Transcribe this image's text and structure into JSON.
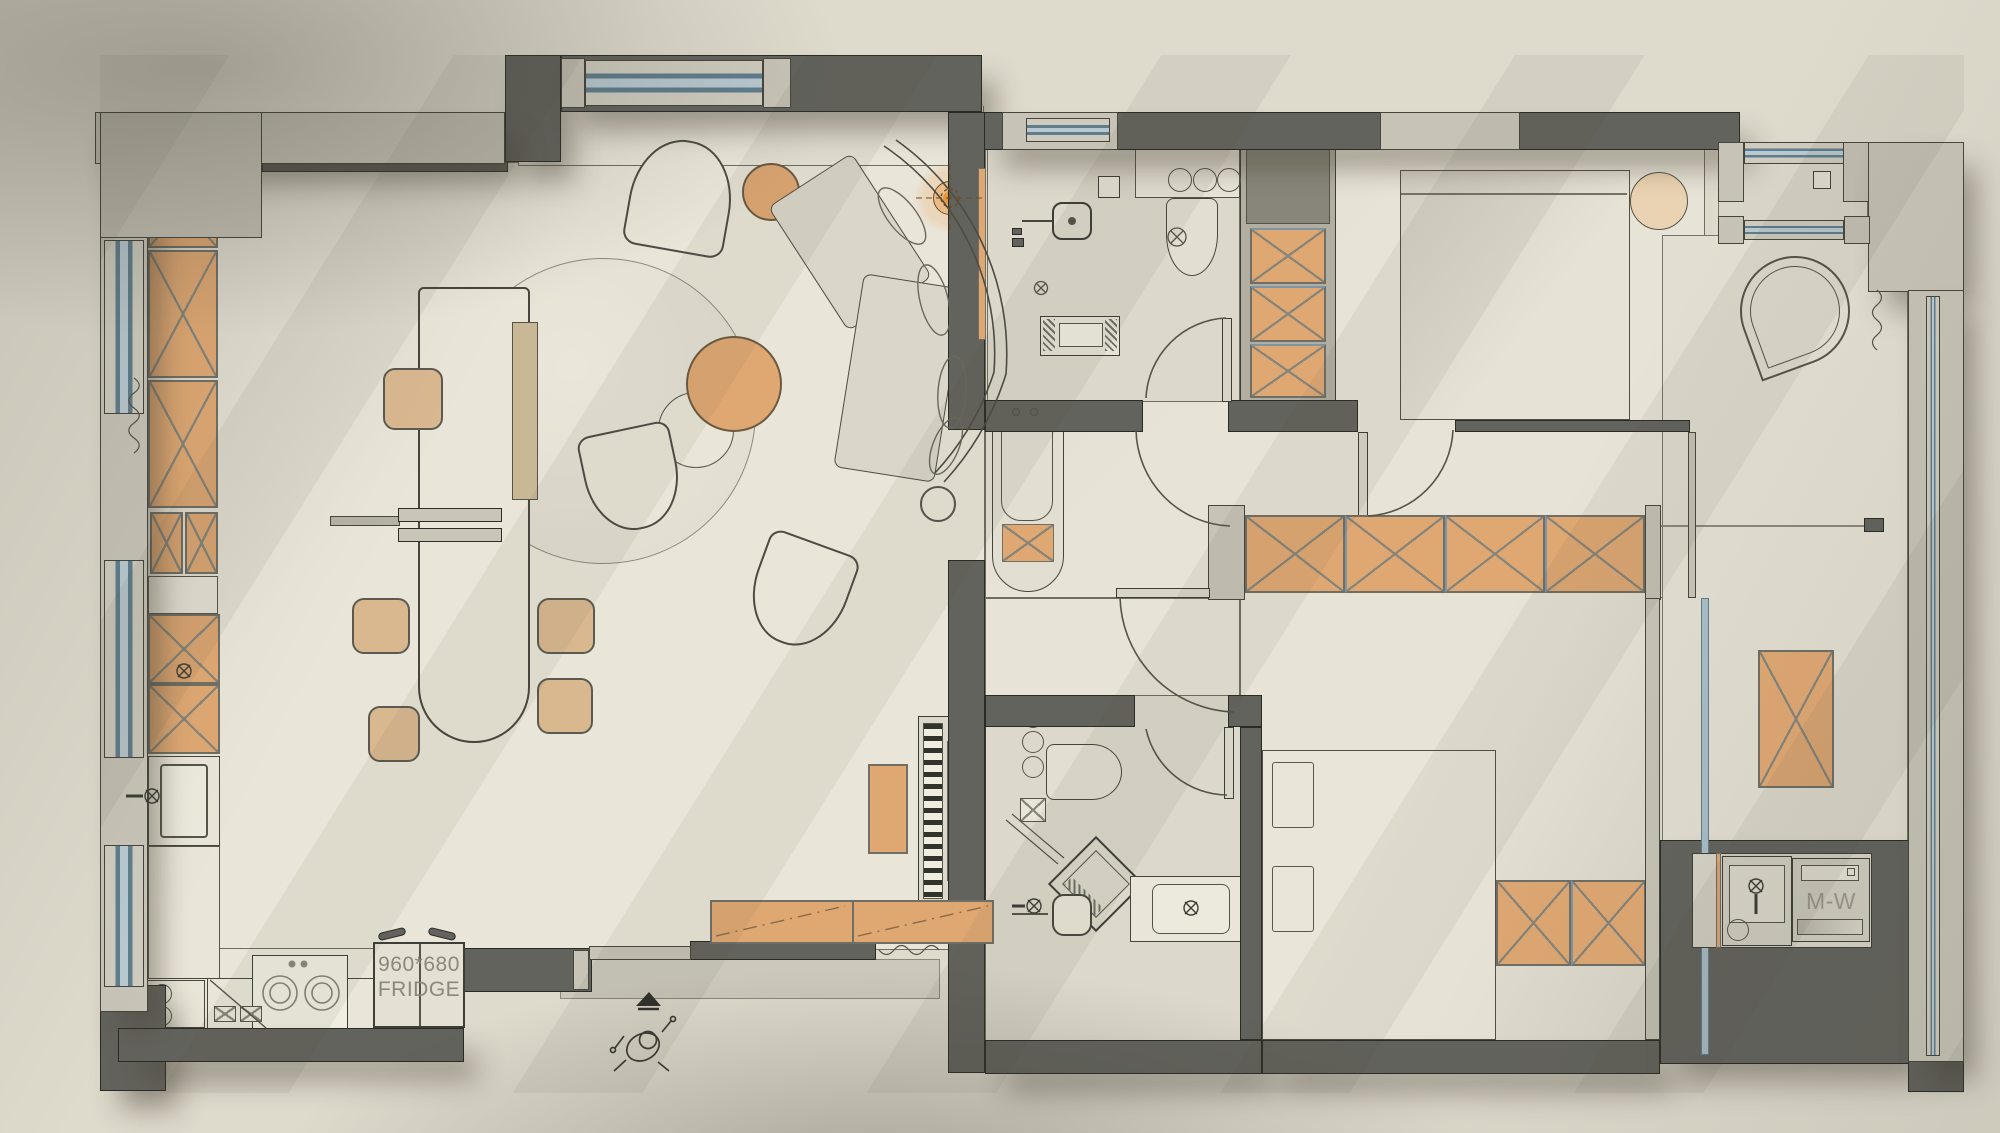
{
  "scene": {
    "kind": "apartment floor plan",
    "view": "top-down rendered CAD drawing"
  },
  "labels": {
    "fridge_dimensions": "960*680",
    "fridge_name": "FRIDGE",
    "washer_dryer": "M-W"
  },
  "palette": {
    "background": "#dedacc",
    "floor": "#e9e5d8",
    "floor_wet": "#dcd8cb",
    "wall_dark": "#63635d",
    "wall_light": "#c7c3b6",
    "furniture_wood": "#dfa873",
    "furniture_wood_light": "#e7cfae",
    "window_glass": "#8fa9b8",
    "linework": "#3b3b34",
    "lamp_glow": "#e8963e"
  },
  "symbols": [
    "floor-drain-icon",
    "ceiling-lamp-icon",
    "stove-burner-icon",
    "faucet-icon",
    "extractor-fan-icon",
    "person-figure-icon",
    "entry-arrow-icon",
    "door-swing-arc",
    "window-glazing",
    "wardrobe-x-panel",
    "curtain-squiggle"
  ]
}
